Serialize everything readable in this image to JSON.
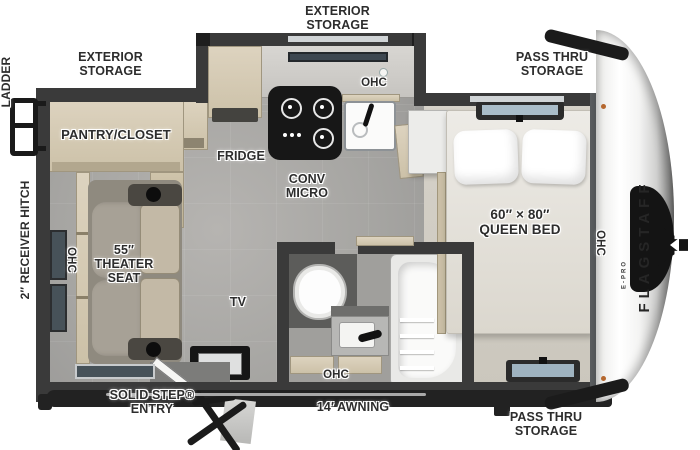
{
  "page": {
    "description": "Travel trailer floor plan, overhead view"
  },
  "brand": {
    "name": "FLAGSTAFF",
    "model": "E-PRO"
  },
  "exterior_labels": {
    "storage_top": "EXTERIOR STORAGE",
    "storage_left": "EXTERIOR STORAGE",
    "pass_thru_top": "PASS THRU STORAGE",
    "pass_thru_bottom": "PASS THRU STORAGE",
    "entry": "SOLID STEP® ENTRY",
    "awning": "14′ AWNING",
    "ladder": "LADDER",
    "receiver_hitch": "2″ RECEIVER HITCH"
  },
  "room_labels": {
    "pantry": "PANTRY/CLOSET",
    "fridge": "FRIDGE",
    "conv_micro": "CONV MICRO",
    "theater_seat": "55″ THEATER SEAT",
    "tv": "TV",
    "bed_size": "60″ × 80″",
    "bed_name": "QUEEN BED",
    "ohc": "OHC"
  },
  "colors": {
    "wall": "#3a3a3a",
    "floor_main": "#a8a7a4",
    "floor_bedroom": "#d3cec4",
    "cabinet_wood": "#d7cdb7",
    "sofa": "#a59f92",
    "cooktop": "#171717",
    "label_text": "#2d2d2d",
    "window_glass": "#475259",
    "marker_light": "#b5672e",
    "front_cap": "#f2f2f1"
  }
}
